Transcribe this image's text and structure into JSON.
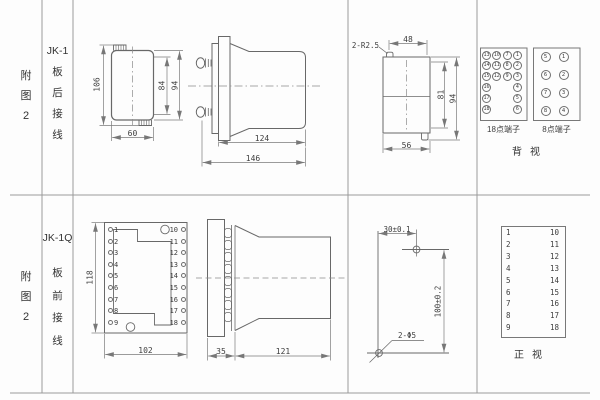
{
  "colors": {
    "line": "#686868",
    "dim": "#7a7a7a",
    "grid": "#9a9a9a",
    "text": "#3a3a3a",
    "background": "#fdfdfd"
  },
  "table": {
    "row1": {
      "fig_label": "附图2",
      "model": "JK-1",
      "wiring": "板后接线",
      "front_view": {
        "dim_total_height": "106",
        "dim_inner_height": "84",
        "dim_outer_height": "94",
        "dim_width": "60"
      },
      "side_view": {
        "dim_body_depth": "124",
        "dim_total_depth": "146"
      },
      "case_view": {
        "corner_label": "2-R2.5",
        "dim_top_width": "48",
        "dim_inner_height": "81",
        "dim_outer_height": "94",
        "dim_bottom_width": "56"
      },
      "back_view": {
        "block18": {
          "label": "18点端子",
          "rows": [
            [
              "13",
              "10",
              "7",
              "1"
            ],
            [
              "14",
              "11",
              "8",
              "2"
            ],
            [
              "15",
              "12",
              "9",
              "3"
            ],
            [
              "16",
              "",
              "",
              "4"
            ],
            [
              "17",
              "",
              "",
              "5"
            ],
            [
              "18",
              "",
              "",
              "6"
            ]
          ]
        },
        "block8": {
          "label": "8点端子",
          "rows": [
            [
              "5",
              "1"
            ],
            [
              "6",
              "2"
            ],
            [
              "7",
              "3"
            ],
            [
              "8",
              "4"
            ]
          ]
        },
        "view_label": "背视"
      }
    },
    "row2": {
      "fig_label": "附图2",
      "model": "JK-1Q",
      "wiring": "板前接线",
      "plate_view": {
        "left_terminals": [
          "1",
          "2",
          "3",
          "4",
          "5",
          "6",
          "7",
          "8",
          "9"
        ],
        "right_terminals": [
          "10",
          "11",
          "12",
          "13",
          "14",
          "15",
          "16",
          "17",
          "18"
        ],
        "dim_height": "118",
        "dim_width": "102"
      },
      "side_view": {
        "dim_plate_depth": "35",
        "dim_body_depth": "121"
      },
      "drill_plan": {
        "dim_horizontal": "30±0.1",
        "dim_vertical": "100±0.2",
        "hole_label": "2-Φ5"
      },
      "front_view": {
        "left_terminals": [
          "1",
          "2",
          "3",
          "4",
          "5",
          "6",
          "7",
          "8",
          "9"
        ],
        "right_terminals": [
          "10",
          "11",
          "12",
          "13",
          "14",
          "15",
          "16",
          "17",
          "18"
        ],
        "view_label": "正视"
      }
    }
  }
}
